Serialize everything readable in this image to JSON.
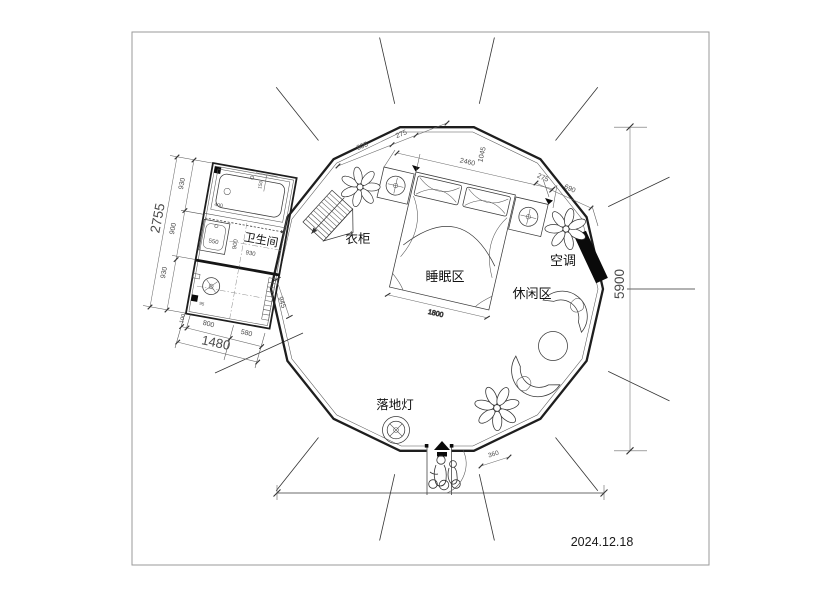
{
  "date": "2024.12.18",
  "labels": {
    "bathroom": "卫生间",
    "wardrobe": "衣柜",
    "sleeping_area": "睡眠区",
    "leisure_area": "休闲区",
    "air_conditioner": "空调",
    "floor_lamp": "落地灯"
  },
  "dimensions": {
    "total_height": "5900",
    "bed_width": "1800",
    "door_width": "360",
    "bath_left_total": "2755",
    "bath_left": [
      "930",
      "900",
      "930"
    ],
    "bath_bottom_total": "1480",
    "bath_bottom": [
      "100",
      "800",
      "580"
    ],
    "bath_gap": "945",
    "bath_interior": {
      "sink": "550",
      "mid_w": "900",
      "mid_w2": "930",
      "tub_w": "400",
      "tub_s": "150",
      "corner": "95"
    },
    "top_left_chain": [
      "805",
      "275"
    ],
    "bed_top_width": "2460",
    "bed_top_depth": "1045",
    "right_chain": [
      "275",
      "690"
    ]
  },
  "colors": {
    "line": "#1e1e1e",
    "dim_text": "#4a4a4a",
    "accent_black": "#0a0a0a"
  }
}
